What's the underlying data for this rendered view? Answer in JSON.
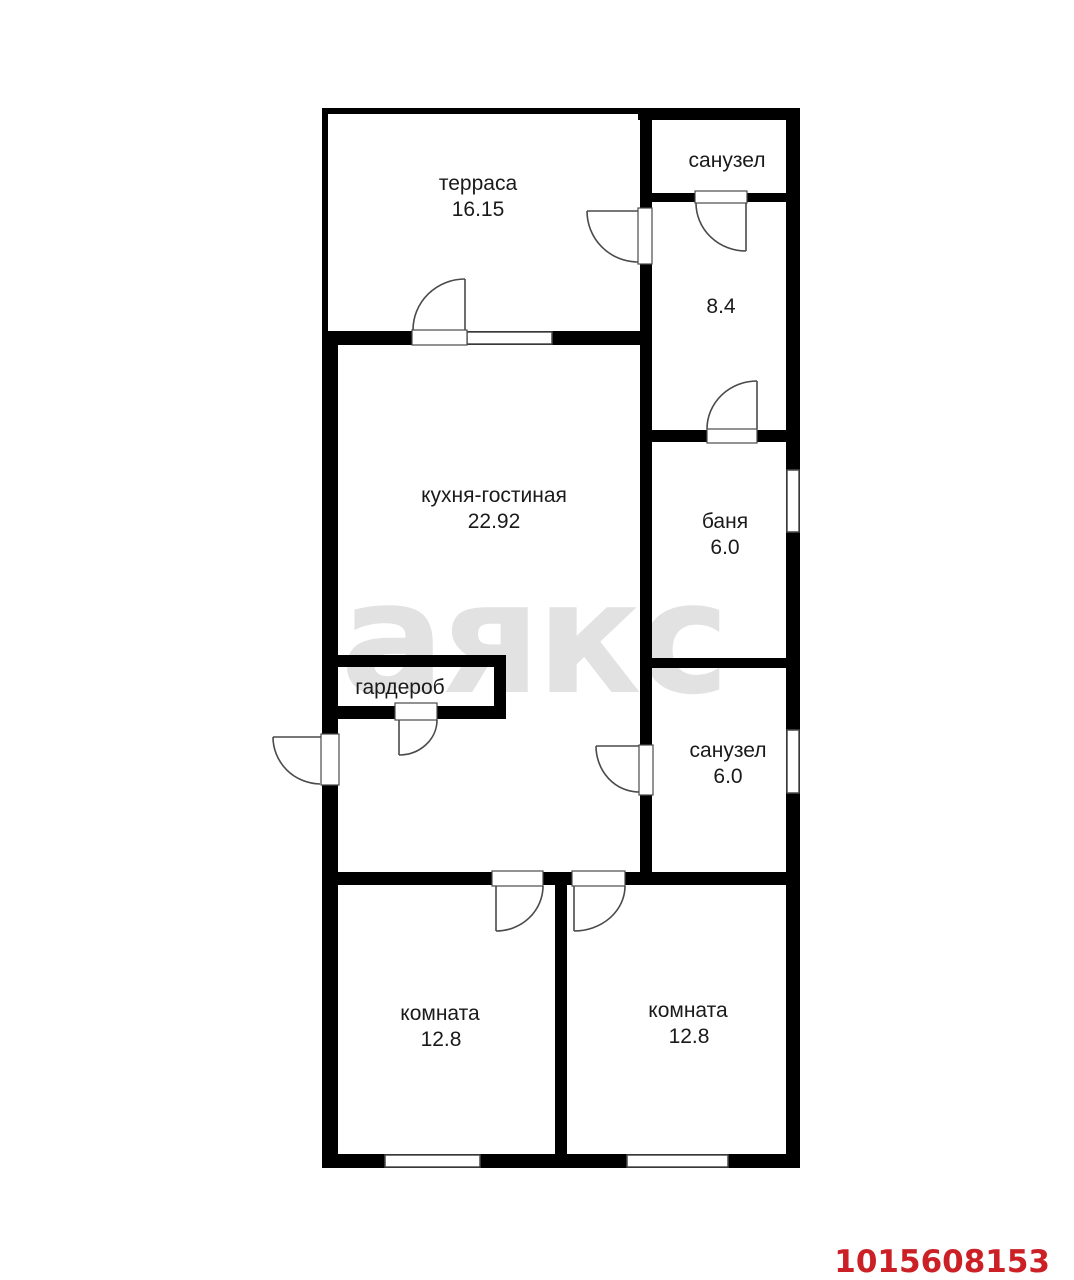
{
  "watermark": {
    "text": "аякс"
  },
  "listing_id": "1015608153",
  "colors": {
    "wall": "#000000",
    "line": "#4a4a4a",
    "text": "#1a1a1a",
    "watermark": "#e2e2e2",
    "listing_red": "#cc2027",
    "background": "#ffffff"
  },
  "rooms": {
    "terrace": {
      "label": "терраса",
      "area": "16.15"
    },
    "bathroom_top": {
      "label": "санузел"
    },
    "hallway": {
      "area": "8.4"
    },
    "kitchen_living": {
      "label": "кухня-гостиная",
      "area": "22.92"
    },
    "sauna": {
      "label": "баня",
      "area": "6.0"
    },
    "wardrobe": {
      "label": "гардероб"
    },
    "bathroom_mid": {
      "label": "санузел",
      "area": "6.0"
    },
    "room_left": {
      "label": "комната",
      "area": "12.8"
    },
    "room_right": {
      "label": "комната",
      "area": "12.8"
    }
  }
}
